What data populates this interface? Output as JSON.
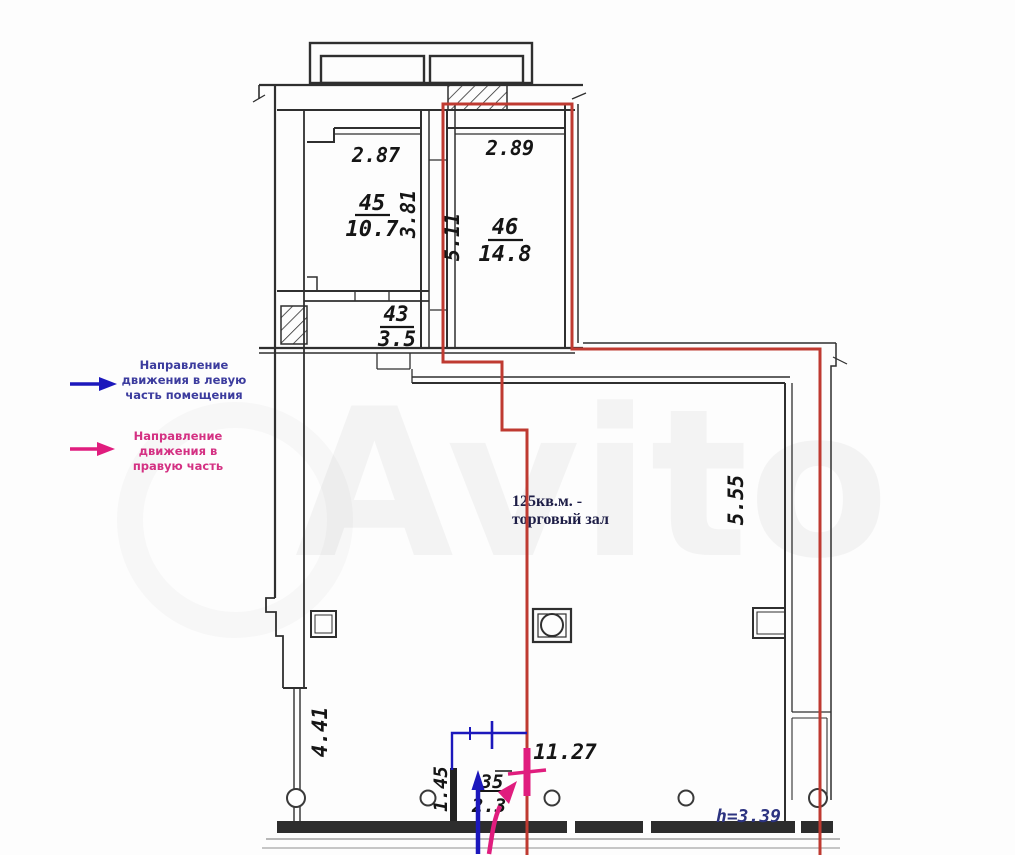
{
  "watermark": "Avito",
  "plan": {
    "rooms": {
      "r45": {
        "number": "45",
        "area": "10.7",
        "dim_top": "2.87",
        "dim_side": "3.81"
      },
      "r46": {
        "number": "46",
        "area": "14.8",
        "dim_top": "2.89",
        "dim_side": "5.11"
      },
      "r43": {
        "number": "43",
        "area": "3.5"
      },
      "r35": {
        "number": "35",
        "area": "2.3",
        "dim_side": "1.45"
      }
    },
    "hall": {
      "label_line1": "125кв.м. -",
      "label_line2": "торговый зал",
      "dim_right": "5.55",
      "dim_left": "4.41",
      "dim_bottom": "11.27",
      "height_note": "h=3.39"
    }
  },
  "legend": {
    "blue_arrow": {
      "line1": "Направление",
      "line2": "движения в левую",
      "line3": "часть помещения"
    },
    "pink_arrow": {
      "line1": "Направление",
      "line2": "движения в",
      "line3": "правую часть"
    }
  },
  "colors": {
    "wall": "#2f2f2f",
    "red_boundary": "#bf3a31",
    "blue": "#1c18bc",
    "pink": "#e01d7e",
    "navy_text": "#2c3380"
  }
}
